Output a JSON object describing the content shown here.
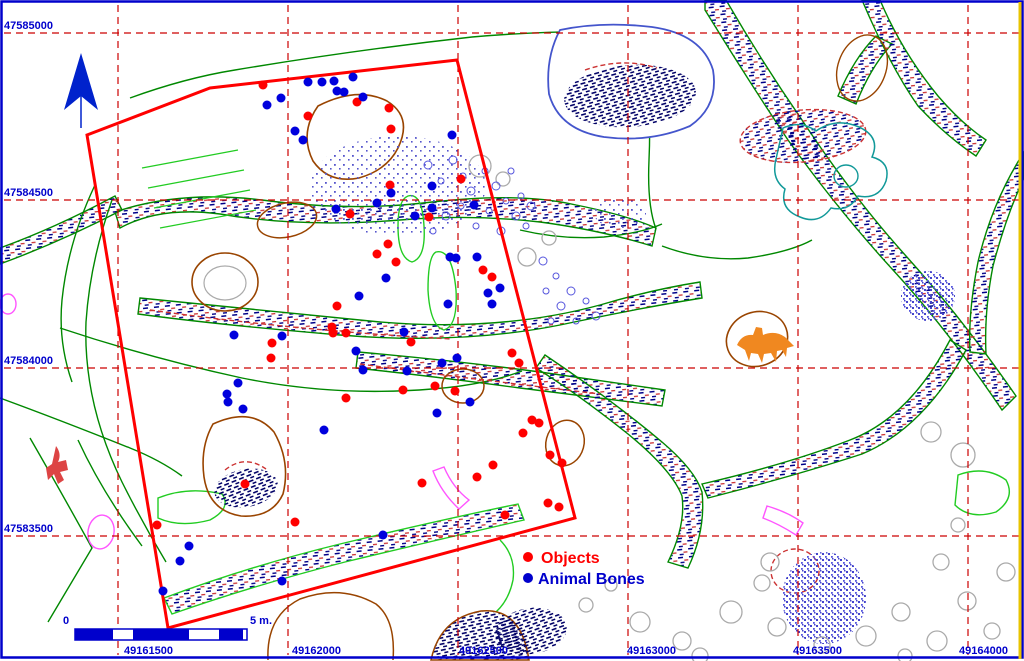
{
  "map_type": "archaeological-site-plan",
  "colors": {
    "grid": "#CC0000",
    "coordinate_labels": "#0000CC",
    "survey_outline": "#FF0000",
    "objects": "#FF0000",
    "animal_bones": "#0000DD",
    "frame": "#0000CC",
    "right_edge": "#E8C400"
  },
  "grid": {
    "v_lines_x": [
      118,
      288,
      458,
      628,
      798,
      968
    ],
    "h_lines_y": [
      33,
      200,
      368,
      536
    ],
    "left_labels": [
      {
        "text": "47585000",
        "y": 29
      },
      {
        "text": "47584500",
        "y": 196
      },
      {
        "text": "47584000",
        "y": 364
      },
      {
        "text": "47583500",
        "y": 532
      }
    ],
    "bottom_labels": [
      {
        "text": "49161500",
        "x": 124
      },
      {
        "text": "49162000",
        "x": 292
      },
      {
        "text": "49162500",
        "x": 459
      },
      {
        "text": "49163000",
        "x": 627
      },
      {
        "text": "49163500",
        "x": 793
      },
      {
        "text": "49164000",
        "x": 959
      }
    ]
  },
  "legend": {
    "objects_label": "Objects",
    "animal_bones_label": "Animal Bones",
    "objects_color": "#FF0000",
    "animal_bones_color": "#0000CC"
  },
  "scalebar": {
    "left_label": "0",
    "right_label": "5 m.",
    "x": 75,
    "y": 629,
    "h": 11,
    "segments": [
      [
        38,
        "#0000CC"
      ],
      [
        20,
        "#FFFFFF"
      ],
      [
        26,
        "#0000CC"
      ],
      [
        30,
        "#0000CC"
      ],
      [
        30,
        "#FFFFFF"
      ],
      [
        24,
        "#0000CC"
      ],
      [
        4,
        "#FFFFFF"
      ]
    ]
  },
  "survey_area": {
    "points": [
      [
        87,
        135
      ],
      [
        210,
        88
      ],
      [
        457,
        60
      ],
      [
        575,
        518
      ],
      [
        168,
        628
      ]
    ]
  },
  "points": {
    "objects": [
      [
        263,
        85
      ],
      [
        308,
        116
      ],
      [
        357,
        102
      ],
      [
        389,
        108
      ],
      [
        391,
        129
      ],
      [
        390,
        185
      ],
      [
        461,
        179
      ],
      [
        350,
        214
      ],
      [
        429,
        217
      ],
      [
        388,
        244
      ],
      [
        377,
        254
      ],
      [
        396,
        262
      ],
      [
        483,
        270
      ],
      [
        492,
        277
      ],
      [
        337,
        306
      ],
      [
        332,
        327
      ],
      [
        333,
        333
      ],
      [
        346,
        333
      ],
      [
        272,
        343
      ],
      [
        271,
        358
      ],
      [
        411,
        342
      ],
      [
        403,
        390
      ],
      [
        346,
        398
      ],
      [
        435,
        386
      ],
      [
        455,
        391
      ],
      [
        512,
        353
      ],
      [
        519,
        363
      ],
      [
        532,
        420
      ],
      [
        539,
        423
      ],
      [
        523,
        433
      ],
      [
        493,
        465
      ],
      [
        550,
        455
      ],
      [
        562,
        463
      ],
      [
        548,
        503
      ],
      [
        559,
        507
      ],
      [
        505,
        515
      ],
      [
        477,
        477
      ],
      [
        422,
        483
      ],
      [
        245,
        484
      ],
      [
        157,
        525
      ],
      [
        295,
        522
      ]
    ],
    "animal_bones": [
      [
        308,
        82
      ],
      [
        322,
        82
      ],
      [
        334,
        81
      ],
      [
        353,
        77
      ],
      [
        337,
        91
      ],
      [
        344,
        92
      ],
      [
        363,
        97
      ],
      [
        267,
        105
      ],
      [
        281,
        98
      ],
      [
        295,
        131
      ],
      [
        303,
        140
      ],
      [
        452,
        135
      ],
      [
        391,
        193
      ],
      [
        432,
        186
      ],
      [
        377,
        203
      ],
      [
        432,
        208
      ],
      [
        474,
        205
      ],
      [
        336,
        209
      ],
      [
        415,
        216
      ],
      [
        450,
        257
      ],
      [
        456,
        258
      ],
      [
        477,
        257
      ],
      [
        386,
        278
      ],
      [
        500,
        288
      ],
      [
        488,
        293
      ],
      [
        492,
        304
      ],
      [
        448,
        304
      ],
      [
        359,
        296
      ],
      [
        234,
        335
      ],
      [
        282,
        336
      ],
      [
        404,
        332
      ],
      [
        356,
        351
      ],
      [
        363,
        370
      ],
      [
        457,
        358
      ],
      [
        442,
        363
      ],
      [
        407,
        371
      ],
      [
        470,
        402
      ],
      [
        437,
        413
      ],
      [
        324,
        430
      ],
      [
        238,
        383
      ],
      [
        227,
        394
      ],
      [
        228,
        402
      ],
      [
        243,
        409
      ],
      [
        383,
        535
      ],
      [
        189,
        546
      ],
      [
        180,
        561
      ],
      [
        282,
        581
      ],
      [
        163,
        591
      ]
    ]
  },
  "terrain": [
    {
      "d": "M115,212 Q180,190 262,200 Q352,212 432,202 Q520,192 576,205 Q626,215 656,228 L652,246 Q600,230 540,222 Q470,214 400,220 Q300,228 220,214 Q160,206 120,228 Z",
      "f": "url(#h1)",
      "s": "#008800"
    },
    {
      "d": "M140,298 Q260,310 380,322 Q500,332 600,305 Q650,290 700,282 L702,298 Q640,308 560,325 Q460,345 340,335 Q220,325 138,314 Z",
      "f": "url(#h1)",
      "s": "#008800"
    },
    {
      "d": "M358,352 Q450,360 540,372 Q610,382 665,390 L662,406 Q600,398 520,388 Q430,376 356,368 Z",
      "f": "url(#h1)",
      "s": "#008800"
    },
    {
      "d": "M705,0 L726,0 Q762,62 802,120 Q852,196 906,256 Q962,318 1016,396 L1002,410 Q948,330 893,270 Q838,210 788,140 Q748,80 705,10 Z",
      "f": "url(#h1)",
      "s": "#008800"
    },
    {
      "d": "M545,355 Q612,400 662,442 Q695,470 702,492 Q706,530 688,568 L668,562 Q686,525 682,496 Q672,470 628,434 Q578,394 536,368 Z",
      "f": "url(#h1)",
      "s": "#008800"
    },
    {
      "d": "M702,484 Q788,464 850,440 Q910,417 950,340 L966,350 Q924,428 862,454 Q794,476 708,498 Z",
      "f": "url(#h1)",
      "s": "#008800"
    },
    {
      "d": "M164,598 Q250,566 340,544 Q440,520 518,504 L524,520 Q445,538 345,562 Q255,585 172,614 Z",
      "f": "url(#h1)",
      "s": "#22CC22"
    },
    {
      "d": "M0,248 Q55,228 115,196 L122,210 Q60,242 0,264 Z",
      "f": "url(#h1)",
      "s": "#008800"
    },
    {
      "d": "M838,96 Q854,58 876,36 L892,44 Q871,66 856,104 Z",
      "f": "url(#h1)",
      "s": "#008800"
    },
    {
      "d": "M880,0 Q902,52 938,96 Q962,124 986,140 L976,156 Q946,136 918,106 Q890,66 862,0 Z",
      "f": "url(#h1)",
      "s": "#008800"
    },
    {
      "d": "M1024,152 Q992,202 978,262 Q968,312 970,352 L986,354 Q984,312 993,266 Q1006,216 1024,178 Z",
      "f": "url(#h1)",
      "s": "#008800"
    },
    {
      "cx": 803,
      "cy": 136,
      "rx": 63,
      "ry": 26,
      "rot": -5,
      "f": "url(#h1)",
      "s": "#CC3333",
      "da": "5,3"
    },
    {
      "d": "M130,98 Q185,78 235,70 Q355,50 472,37 Q565,29 641,33 Q652,95 649,160 Q647,205 656,229",
      "s": "#008800"
    },
    {
      "d": "M60,328 Q150,358 242,378 Q335,397 432,389 Q485,385 522,371",
      "s": "#008800"
    },
    {
      "d": "M95,185 Q68,242 62,300 Q58,342 72,382",
      "s": "#008800"
    },
    {
      "d": "M112,200 Q90,262 86,322 Q83,402 122,482 Q142,522 166,562",
      "s": "#008800"
    },
    {
      "d": "M520,230 Q562,240 604,237 Q642,233 662,224",
      "s": "#008800"
    },
    {
      "d": "M662,246 Q705,262 748,258 Q790,252 812,240",
      "s": "#008800"
    },
    {
      "d": "M0,398 Q60,420 130,448 Q160,460 182,476",
      "s": "#008800"
    },
    {
      "d": "M30,438 Q60,490 92,548 Q70,585 48,622",
      "s": "#008800"
    },
    {
      "d": "M78,440 Q102,492 142,546",
      "s": "#008800"
    },
    {
      "d": "M142,168 L238,150 M148,188 L244,170 M154,208 L250,190 M160,228 L256,210",
      "s": "#22CC22",
      "w": 1.2
    },
    {
      "d": "M408,196 Q422,192 424,226 Q426,258 412,262 Q398,258 398,226 Q398,200 408,196 Z",
      "s": "#22CC22"
    },
    {
      "d": "M436,252 Q452,248 456,290 Q458,326 444,330 Q430,326 428,290 Q428,256 436,252 Z",
      "s": "#22CC22"
    },
    {
      "d": "M158,498 Q188,486 222,494 Q232,508 210,520 Q180,528 158,518 Z",
      "s": "#22CC22"
    },
    {
      "d": "M500,540 Q516,556 513,580 Q509,600 496,612",
      "s": "#22CC22"
    },
    {
      "d": "M958,475 Q985,465 1006,480 Q1016,498 996,512 Q970,520 955,505 Z",
      "s": "#22CC22"
    },
    {
      "d": "M560,30 Q602,21 652,27 Q702,34 713,70 Q719,106 690,126 Q650,143 604,137 Q559,130 549,94 Q545,58 560,30 Z",
      "s": "#4455CC",
      "f": "#FFFFFF",
      "w": 1.8
    },
    {
      "cx": 630,
      "cy": 96,
      "rx": 66,
      "ry": 31,
      "rot": -4,
      "f": "url(#h2)"
    },
    {
      "d": "M585,70 Q622,57 657,68",
      "s": "#CC3333",
      "da": "5,3"
    },
    {
      "cx": 225,
      "cy": 282,
      "rx": 33,
      "ry": 29,
      "s": "#994400",
      "w": 1.6
    },
    {
      "cx": 225,
      "cy": 283,
      "rx": 21,
      "ry": 17,
      "s": "#AAAAAA",
      "w": 1.2
    },
    {
      "d": "M213,424 Q252,406 274,432 Q291,462 283,494 Q272,518 241,516 Q209,511 204,477 Q200,447 213,424 Z",
      "s": "#994400",
      "w": 1.6
    },
    {
      "cx": 246,
      "cy": 488,
      "rx": 32,
      "ry": 19,
      "rot": -10,
      "f": "url(#h2)"
    },
    {
      "d": "M318,106 Q357,86 387,101 Q413,117 398,148 Q387,170 359,178 Q329,184 313,161 Q299,133 318,106 Z",
      "s": "#994400",
      "w": 1.6
    },
    {
      "cx": 287,
      "cy": 220,
      "rx": 30,
      "ry": 17,
      "rot": -12,
      "s": "#994400",
      "w": 1.5
    },
    {
      "cx": 463,
      "cy": 386,
      "rx": 21,
      "ry": 17,
      "s": "#994400",
      "w": 1.5
    },
    {
      "cx": 565,
      "cy": 443,
      "rx": 19,
      "ry": 23,
      "rot": 15,
      "s": "#994400",
      "w": 1.5
    },
    {
      "cx": 757,
      "cy": 339,
      "rx": 31,
      "ry": 27,
      "rot": -20,
      "s": "#994400",
      "w": 1.6
    },
    {
      "d": "M737,345 q5,-11 16,-10 l3,-8 6,1 1,7 q12,-5 22,2 l9,9 -7,2 -1,9 -4,-7 -5,1 -1,11 -5,-9 -7,1 -2,9 -4,-9 -7,-1 -2,8 -4,-11 -8,-5 Z",
      "f": "#F08820"
    },
    {
      "d": "M268,660 Q266,616 300,599 Q341,584 376,604 Q396,620 393,660",
      "s": "#994400",
      "w": 1.5
    },
    {
      "d": "M431,660 Q440,618 481,611 Q521,607 529,660 Z",
      "s": "#994400",
      "f": "url(#h2)",
      "w": 1.5
    },
    {
      "cx": 862,
      "cy": 68,
      "rx": 24,
      "ry": 34,
      "rot": 20,
      "s": "#994400",
      "w": 1.4
    },
    {
      "d": "M783,128 Q801,120 816,131 Q836,117 859,127 Q881,137 872,157 Q891,162 886,181 Q879,200 858,196 Q849,212 831,208 Q819,225 800,217 Q779,209 785,189 Q771,179 776,159 Q780,141 783,128 Z",
      "s": "#119999",
      "w": 1.5
    },
    {
      "cx": 846,
      "cy": 176,
      "rx": 12,
      "ry": 11,
      "s": "#119999",
      "w": 1.4
    },
    {
      "cx": 101,
      "cy": 532,
      "rx": 13,
      "ry": 17,
      "rot": 10,
      "s": "#FF55FF"
    },
    {
      "d": "M444,467 Q453,488 469,500 L459,509 Q441,492 433,471 Z",
      "s": "#FF55FF"
    },
    {
      "d": "M767,506 Q788,512 803,523 L796,535 Q779,524 763,518 Z",
      "s": "#FF55FF"
    },
    {
      "cx": 8,
      "cy": 304,
      "rx": 8,
      "ry": 10,
      "s": "#FF55FF"
    },
    {
      "cx": 795,
      "cy": 571,
      "rx": 24,
      "ry": 22,
      "s": "#CC3333",
      "da": "5,3"
    },
    {
      "d": "M225,470 Q245,454 266,469",
      "s": "#CC3333",
      "da": "5,3"
    },
    {
      "d": "M360,364 Q480,380 600,394",
      "s": "#CC3333",
      "da": "5,3"
    },
    {
      "d": "M150,310 Q300,331 452,339",
      "s": "#CC3333",
      "da": "5,3"
    },
    {
      "d": "M56,446 q6,8 2,16 l8,-2 2,10 -8,2 4,8 -6,4 -4,-10 -6,6 -2,-12 6,-4 Z",
      "f": "#DD4444"
    },
    {
      "cx": 398,
      "cy": 186,
      "rx": 88,
      "ry": 50,
      "f": "url(#spk)"
    },
    {
      "cx": 620,
      "cy": 213,
      "rx": 26,
      "ry": 15,
      "f": "url(#spk)"
    },
    {
      "cx": 928,
      "cy": 296,
      "rx": 27,
      "ry": 25,
      "f": "url(#spk2)"
    },
    {
      "cx": 824,
      "cy": 598,
      "rx": 42,
      "ry": 46,
      "f": "url(#spk2)"
    },
    {
      "cx": 531,
      "cy": 631,
      "rx": 36,
      "ry": 23,
      "rot": -8,
      "f": "url(#h2)"
    }
  ],
  "gray_circles": [
    [
      480,
      166,
      11
    ],
    [
      503,
      179,
      7
    ],
    [
      527,
      257,
      9
    ],
    [
      549,
      238,
      7
    ],
    [
      931,
      432,
      10
    ],
    [
      963,
      455,
      12
    ],
    [
      770,
      562,
      9
    ],
    [
      640,
      622,
      10
    ],
    [
      682,
      641,
      9
    ],
    [
      731,
      612,
      11
    ],
    [
      762,
      583,
      8
    ],
    [
      777,
      627,
      9
    ],
    [
      822,
      645,
      8
    ],
    [
      866,
      636,
      10
    ],
    [
      901,
      612,
      9
    ],
    [
      937,
      641,
      10
    ],
    [
      967,
      601,
      9
    ],
    [
      992,
      631,
      8
    ],
    [
      1006,
      572,
      9
    ],
    [
      941,
      562,
      8
    ],
    [
      905,
      656,
      7
    ],
    [
      700,
      656,
      8
    ],
    [
      586,
      605,
      7
    ],
    [
      611,
      585,
      6
    ],
    [
      958,
      525,
      7
    ]
  ],
  "blue_circles": [
    [
      428,
      165,
      4
    ],
    [
      441,
      181,
      3
    ],
    [
      453,
      160,
      4
    ],
    [
      463,
      176,
      3
    ],
    [
      471,
      191,
      4
    ],
    [
      485,
      171,
      3
    ],
    [
      496,
      186,
      4
    ],
    [
      506,
      201,
      3
    ],
    [
      516,
      216,
      4
    ],
    [
      489,
      211,
      3
    ],
    [
      461,
      206,
      3
    ],
    [
      446,
      216,
      4
    ],
    [
      433,
      231,
      3
    ],
    [
      476,
      226,
      3
    ],
    [
      501,
      231,
      4
    ],
    [
      521,
      196,
      3
    ],
    [
      511,
      171,
      3
    ],
    [
      531,
      206,
      4
    ],
    [
      526,
      226,
      3
    ],
    [
      543,
      261,
      4
    ],
    [
      556,
      276,
      3
    ],
    [
      571,
      291,
      4
    ],
    [
      586,
      301,
      3
    ],
    [
      561,
      306,
      4
    ],
    [
      546,
      291,
      3
    ],
    [
      596,
      316,
      4
    ],
    [
      576,
      321,
      3
    ],
    [
      551,
      321,
      3
    ]
  ]
}
